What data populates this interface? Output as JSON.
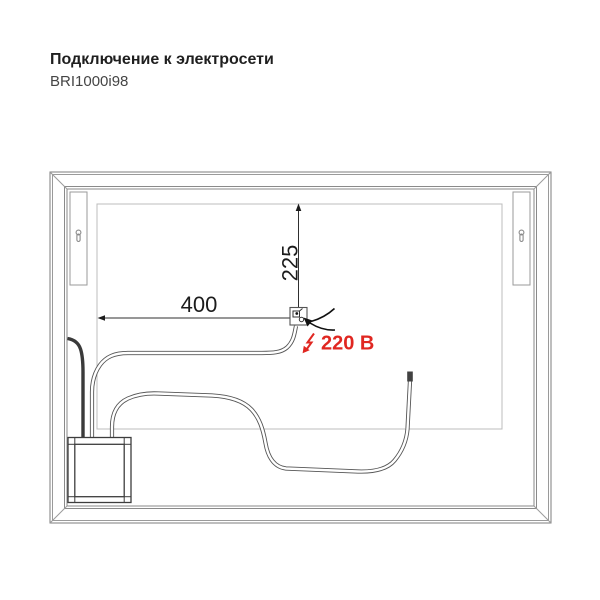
{
  "header": {
    "title": "Подключение к электросети",
    "model": "BRI1000i98"
  },
  "diagram": {
    "dim_horizontal": {
      "value": "400"
    },
    "dim_vertical": {
      "value": "225"
    },
    "power": {
      "label": "220 В",
      "color": "#e02721"
    },
    "colors": {
      "frame_line": "#8a8a8a",
      "panel_line": "#bcbcbc",
      "cable": "#555555",
      "dark_cable": "#3a3a3a",
      "dimension_line": "#2f2f2f"
    },
    "icons": {
      "brackets": "keyhole-icon",
      "power": "lightning-icon",
      "pointer": "leader-arrow-icon"
    }
  }
}
